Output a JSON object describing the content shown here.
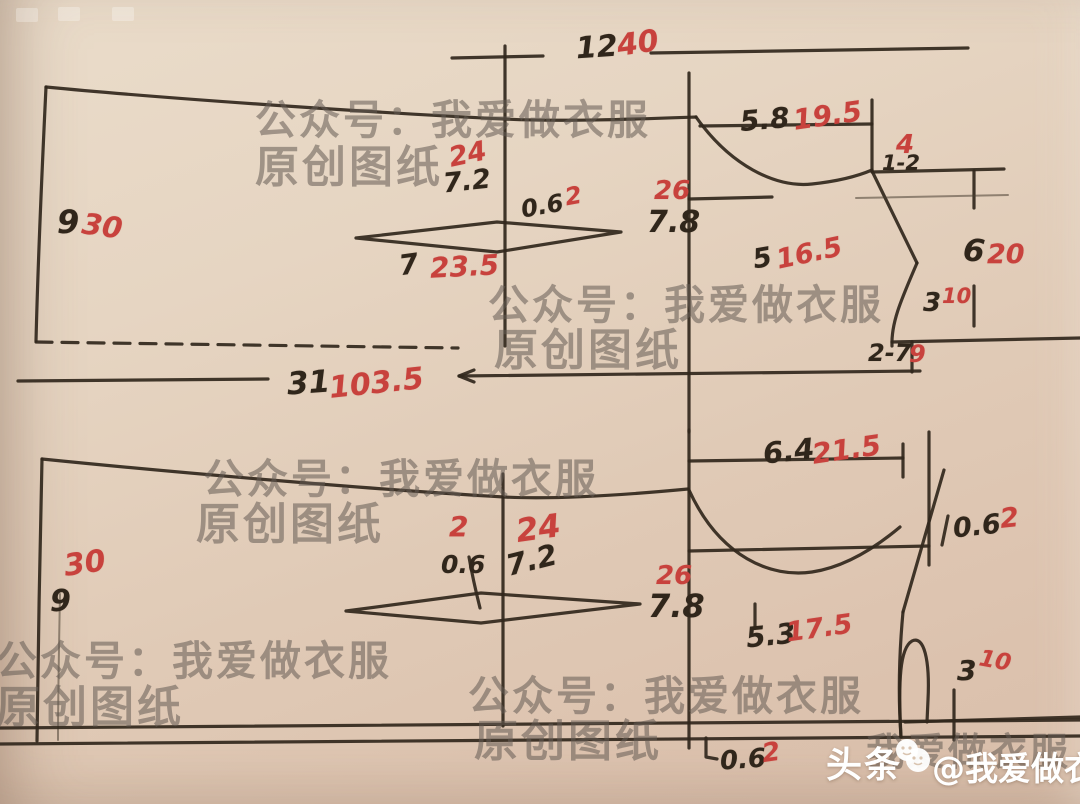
{
  "watermark": {
    "account_line": "公众号：我爱做衣服",
    "origin_line": "原创图纸",
    "brand_name": "我爱做衣服"
  },
  "badge": {
    "platform": "头条",
    "handle": "@我爱做衣服"
  },
  "colors": {
    "ink": "#30261b",
    "red_ink": "#c8423d",
    "paper": "#e2cfbc",
    "watermark_gray": "#8a8078"
  },
  "top_pattern": {
    "width": {
      "black": "12",
      "red": "40"
    },
    "back_length_left": {
      "black": "9",
      "red": "30"
    },
    "center_offset": {
      "red": "24",
      "black": "7.2"
    },
    "dart_ease": {
      "black": "0.6",
      "red": "2"
    },
    "dart_length": {
      "black": "7",
      "red": "23.5"
    },
    "neck_depth": {
      "red": "26",
      "black": "7.8"
    },
    "shoulder_width": {
      "black": "5.8",
      "red": "19.5"
    },
    "shoulder_drop": {
      "red": "4",
      "black": "1-2"
    },
    "neck_width": {
      "black": "5",
      "red": "16.5"
    },
    "side_length": {
      "black": "6",
      "red": "20"
    },
    "armhole_depth": {
      "black": "3",
      "red": "10"
    },
    "armhole_width": {
      "black": "2-7",
      "red": "9"
    },
    "total_length": {
      "black": "31",
      "red": "103.5"
    }
  },
  "bottom_pattern": {
    "front_length_left": {
      "red": "30",
      "black": "9"
    },
    "dart_ease": {
      "red": "2",
      "black": "0.6"
    },
    "center_offset": {
      "red": "24",
      "black": "7.2"
    },
    "neck_depth": {
      "red": "26",
      "black": "7.8"
    },
    "shoulder_width": {
      "black": "6.4",
      "red": "21.5"
    },
    "edge_ease_right": {
      "black": "0.6",
      "red": "2"
    },
    "neck_width": {
      "black": "5.3",
      "red": "17.5"
    },
    "armhole_depth": {
      "black": "3",
      "red": "10"
    },
    "hem_ease": {
      "black": "0.6",
      "red": "2"
    }
  }
}
